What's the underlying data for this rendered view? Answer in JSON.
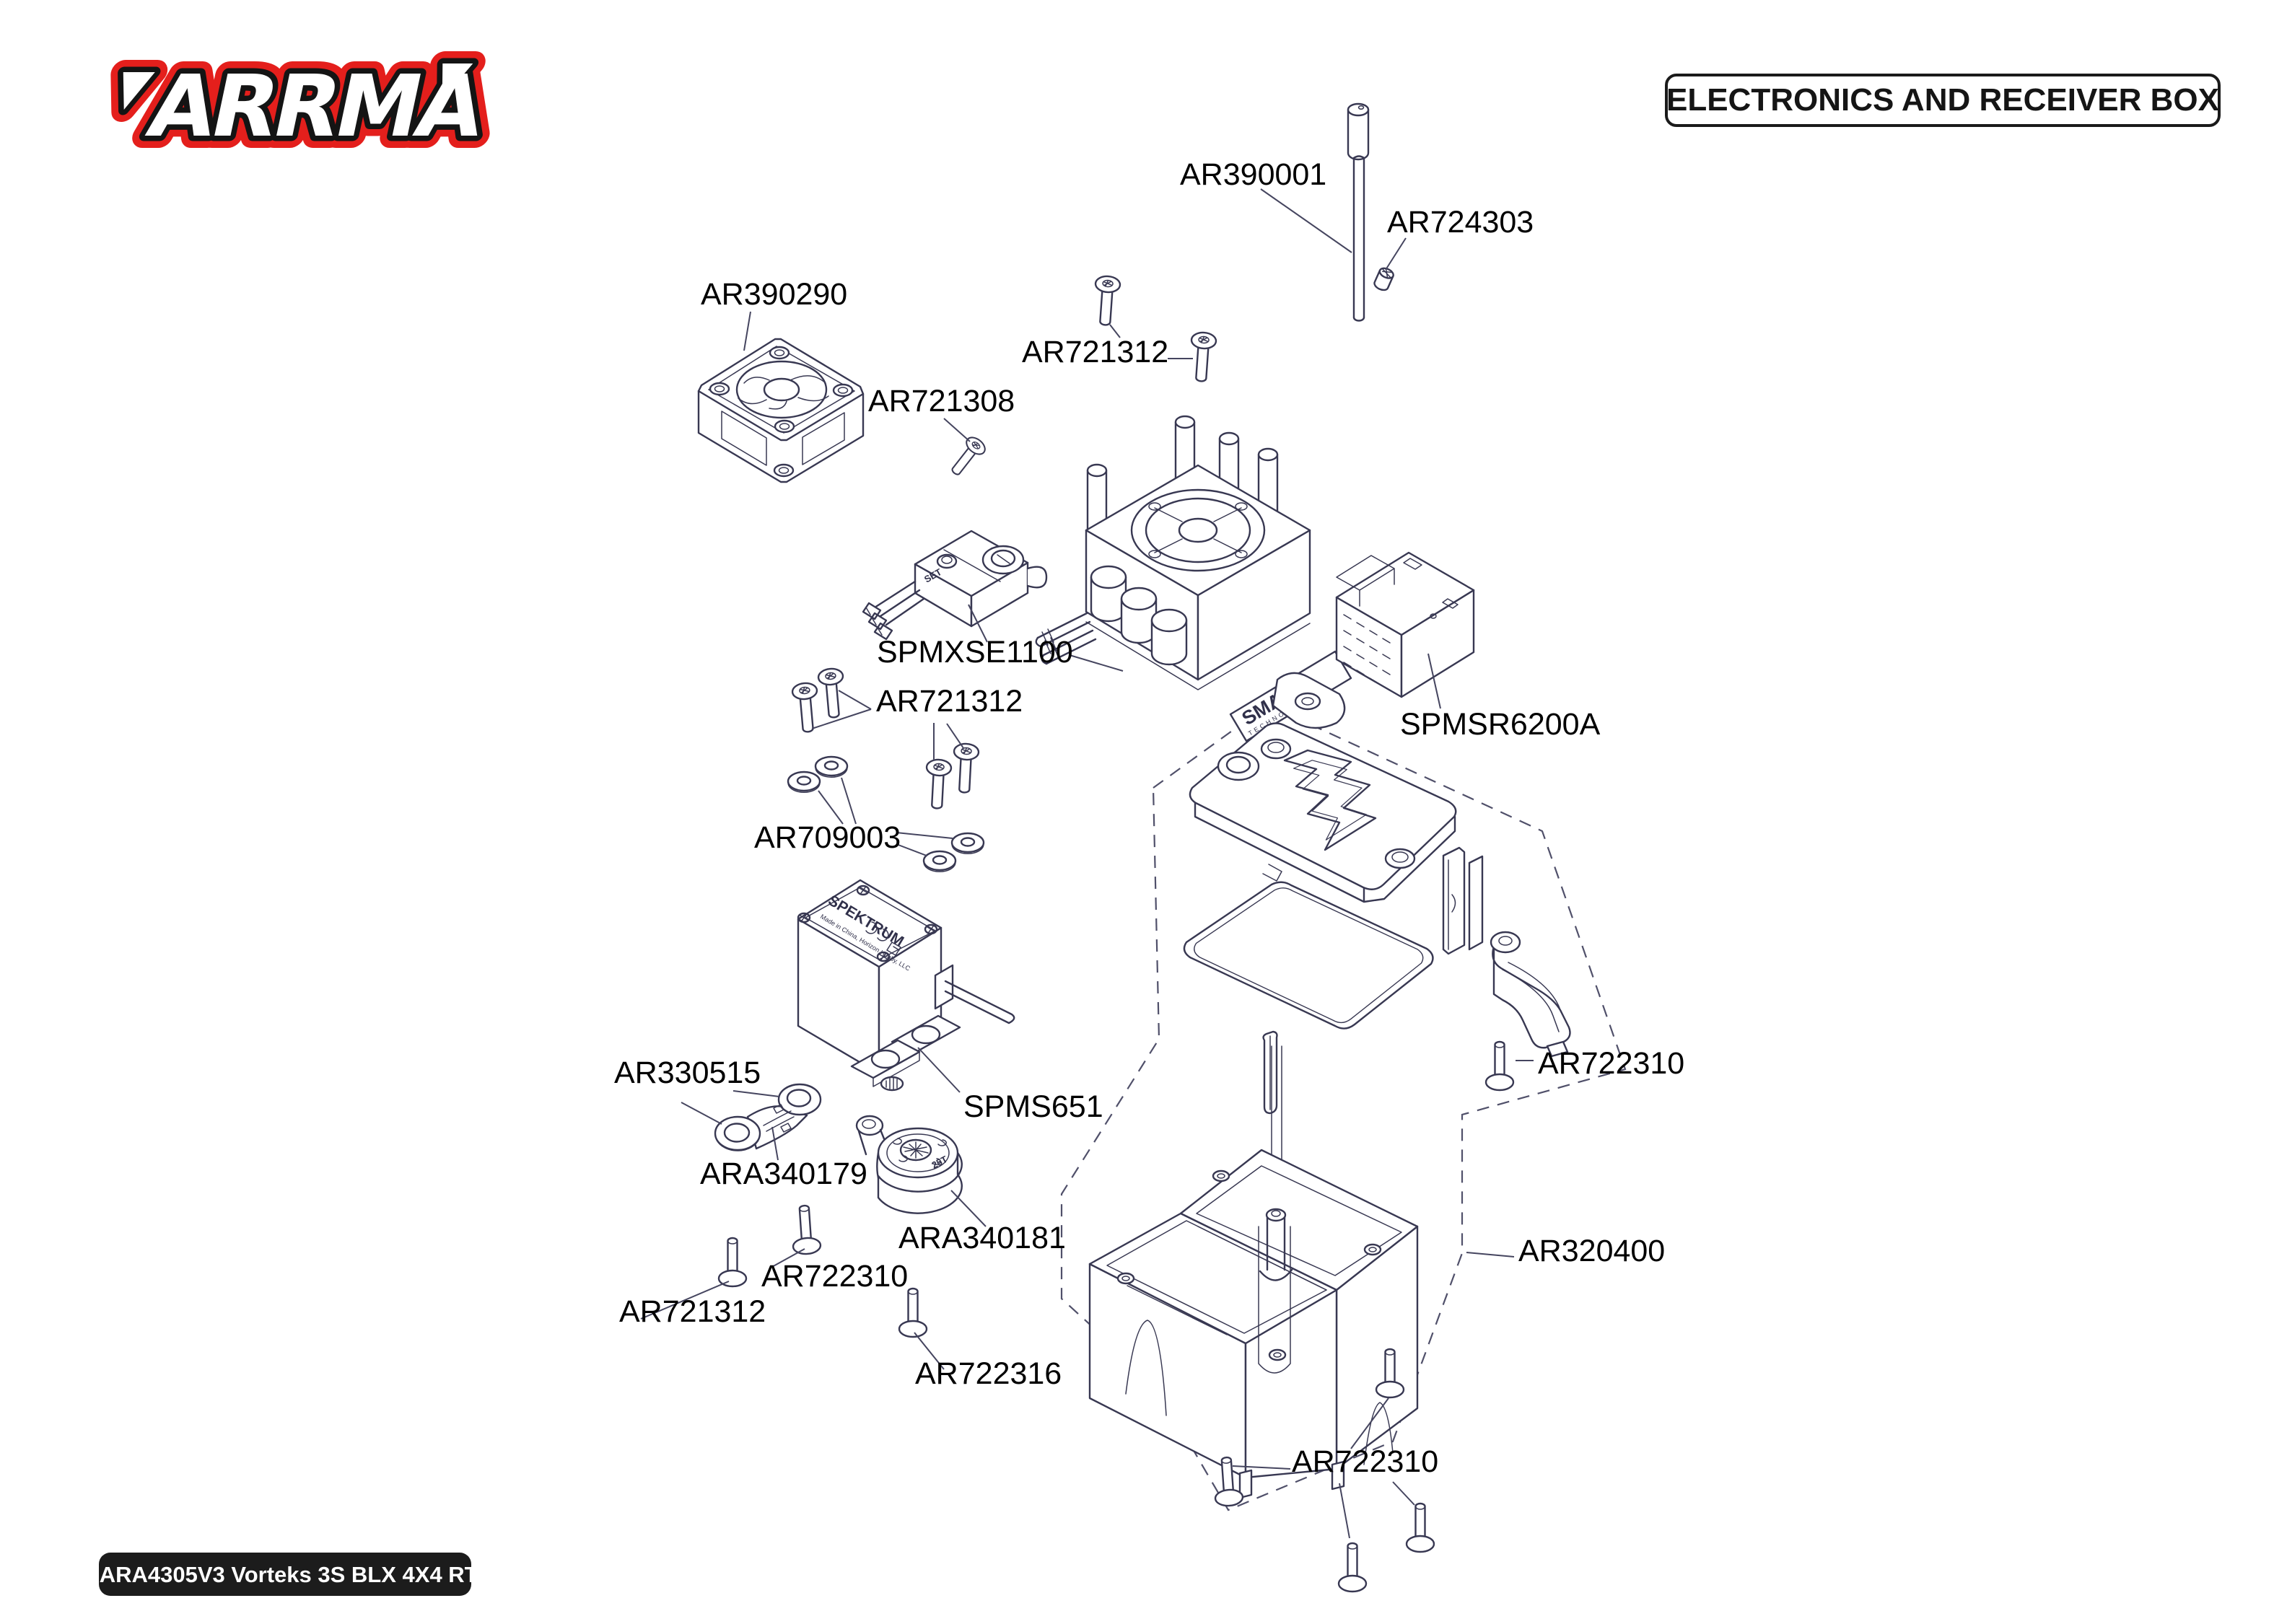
{
  "header": {
    "logo_text": "ARRMA",
    "title": "ELECTRONICS AND RECEIVER BOX"
  },
  "footer": {
    "kit_code": "C-ARA4305V3 Vorteks 3S BLX 4X4 RTR"
  },
  "colors": {
    "brand_red": "#e41f1c",
    "drawing_line_navy": "#383852",
    "label_black": "#000000"
  },
  "diagram": {
    "part_labels": [
      {
        "id": "AR390001",
        "text": "AR390001"
      },
      {
        "id": "AR724303",
        "text": "AR724303"
      },
      {
        "id": "AR390290",
        "text": "AR390290"
      },
      {
        "id": "AR721308",
        "text": "AR721308"
      },
      {
        "id": "AR721312-top",
        "text": "AR721312"
      },
      {
        "id": "SPMXSE1100",
        "text": "SPMXSE1100"
      },
      {
        "id": "SPMSR6200A",
        "text": "SPMSR6200A"
      },
      {
        "id": "AR721312-mid",
        "text": "AR721312"
      },
      {
        "id": "AR709003",
        "text": "AR709003"
      },
      {
        "id": "SPMS651",
        "text": "SPMS651"
      },
      {
        "id": "AR330515",
        "text": "AR330515"
      },
      {
        "id": "ARA340179",
        "text": "ARA340179"
      },
      {
        "id": "ARA340181",
        "text": "ARA340181"
      },
      {
        "id": "AR722310-left",
        "text": "AR722310"
      },
      {
        "id": "AR721312-bottom",
        "text": "AR721312"
      },
      {
        "id": "AR722316",
        "text": "AR722316"
      },
      {
        "id": "AR722310-right",
        "text": "AR722310"
      },
      {
        "id": "AR320400",
        "text": "AR320400"
      },
      {
        "id": "AR722310-bottom",
        "text": "AR722310"
      }
    ],
    "drawing_texts": {
      "esc_brand": "SMART",
      "esc_brand_sub": "TECHNOLOGY",
      "servo_brand": "SPEKTRUM",
      "servo_origin": "Made in China, Horizon Hobby, LLC",
      "switch_button": "SET",
      "saver_spline": "25T"
    }
  }
}
